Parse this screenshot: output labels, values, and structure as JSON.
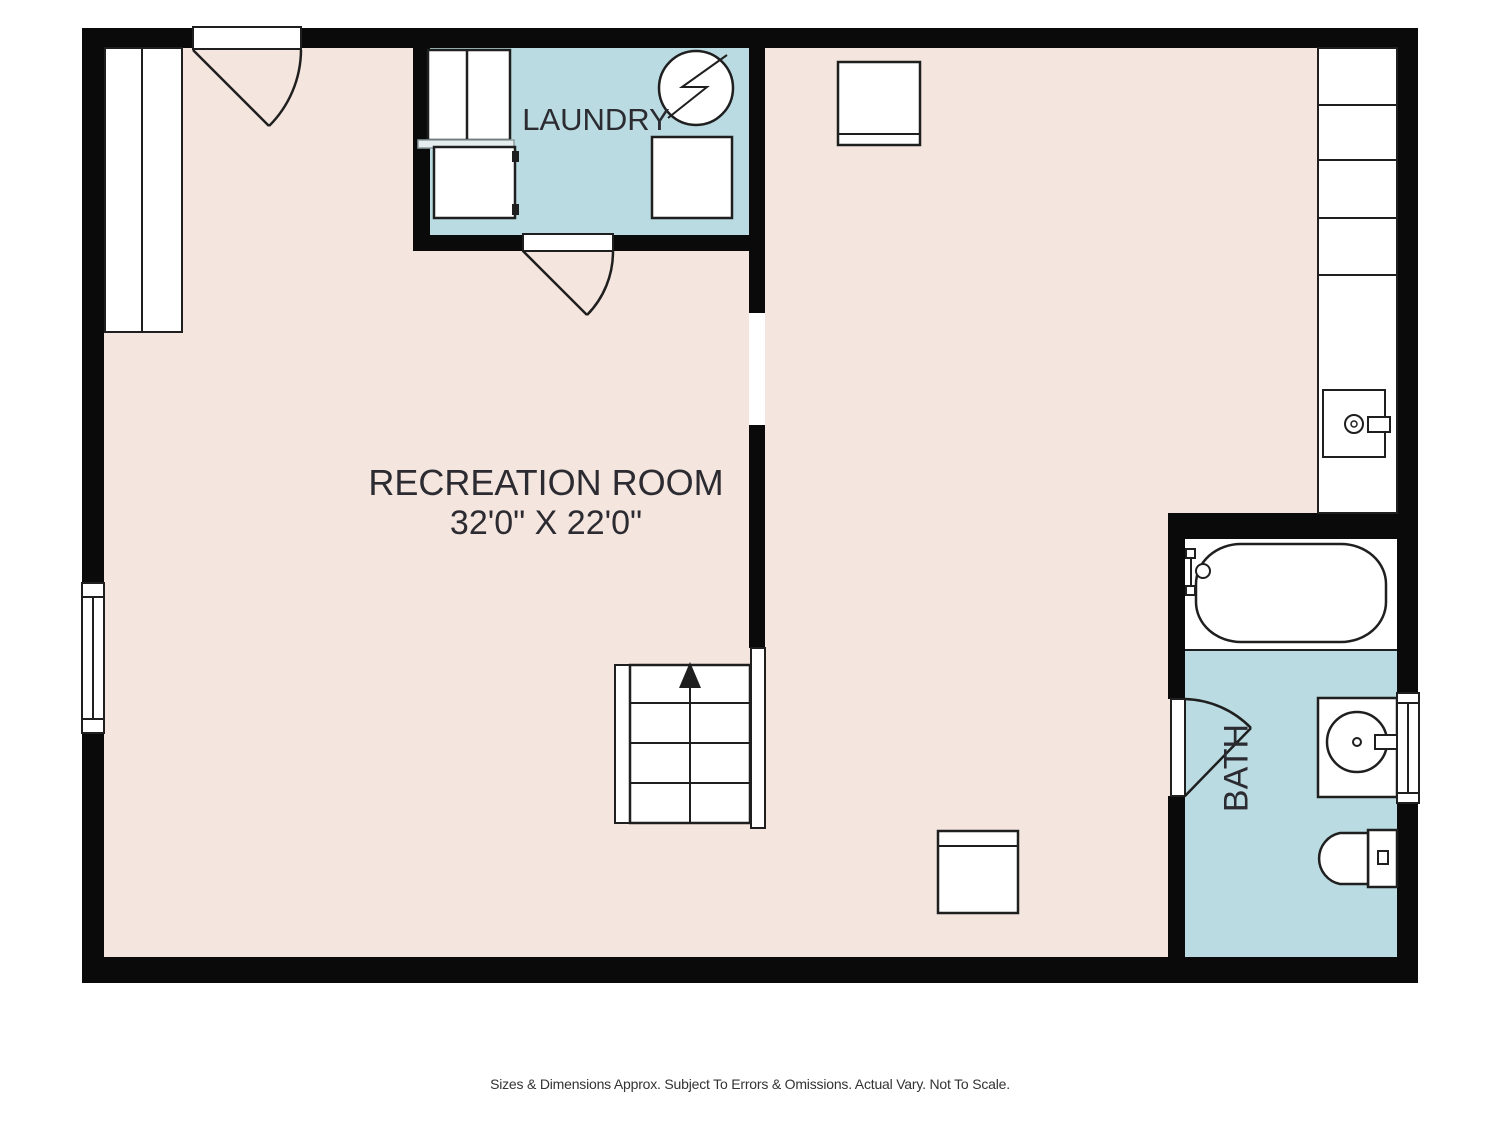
{
  "colors": {
    "wall": "#0a0a0a",
    "floor": "#f4e5de",
    "wet": "#b9dbe1",
    "line": "#1f1f1f",
    "text": "#2b2b31",
    "muted": "#333333"
  },
  "rooms": {
    "laundry": {
      "label": "LAUNDRY"
    },
    "recreation": {
      "label": "RECREATION ROOM",
      "dimensions": "32'0\" X 22'0\""
    },
    "bath": {
      "label": "BATH"
    }
  },
  "footer": {
    "disclaimer": "Sizes & Dimensions Approx. Subject To Errors & Omissions. Actual Vary. Not To Scale."
  }
}
